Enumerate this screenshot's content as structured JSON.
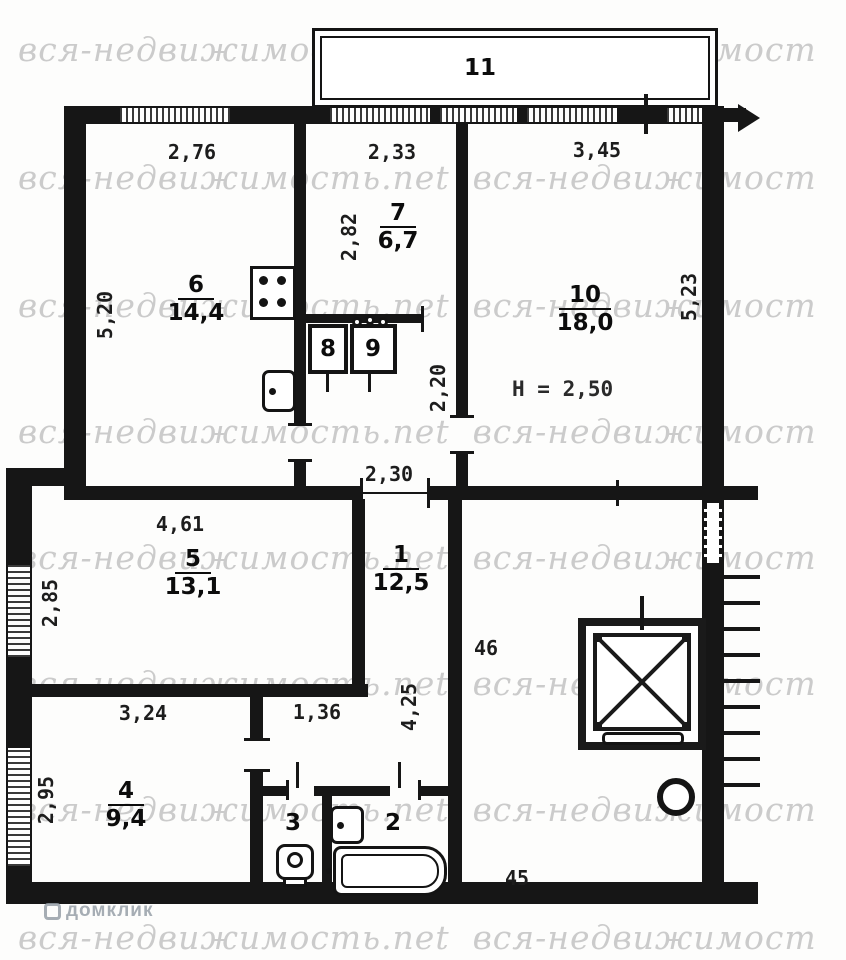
{
  "watermark": {
    "text": "вся-недвижимость.net",
    "text_right": "вся-недвижимост",
    "brand": "домклик"
  },
  "rooms": {
    "balcony": {
      "num": "11"
    },
    "kitchen": {
      "num": "6",
      "area": "14,4"
    },
    "room7": {
      "num": "7",
      "area": "6,7"
    },
    "closet8": {
      "num": "8"
    },
    "closet9": {
      "num": "9"
    },
    "room10": {
      "num": "10",
      "area": "18,0",
      "ceiling": "Н = 2,50"
    },
    "room5": {
      "num": "5",
      "area": "13,1"
    },
    "hall1": {
      "num": "1",
      "area": "12,5"
    },
    "room4": {
      "num": "4",
      "area": "9,4"
    },
    "wc3": {
      "num": "3"
    },
    "bath2": {
      "num": "2"
    }
  },
  "dims": {
    "d276": "2,76",
    "d233": "2,33",
    "d345": "3,45",
    "d520": "5,20",
    "d282": "2,82",
    "d523": "5,23",
    "d220": "2,20",
    "d230": "2,30",
    "d461": "4,61",
    "d285": "2,85",
    "d136": "1,36",
    "d425": "4,25",
    "d46": "46",
    "d324": "3,24",
    "d295": "2,95",
    "d45": "45"
  },
  "colors": {
    "ink": "#161616",
    "watermark": "#cbcbcb"
  }
}
